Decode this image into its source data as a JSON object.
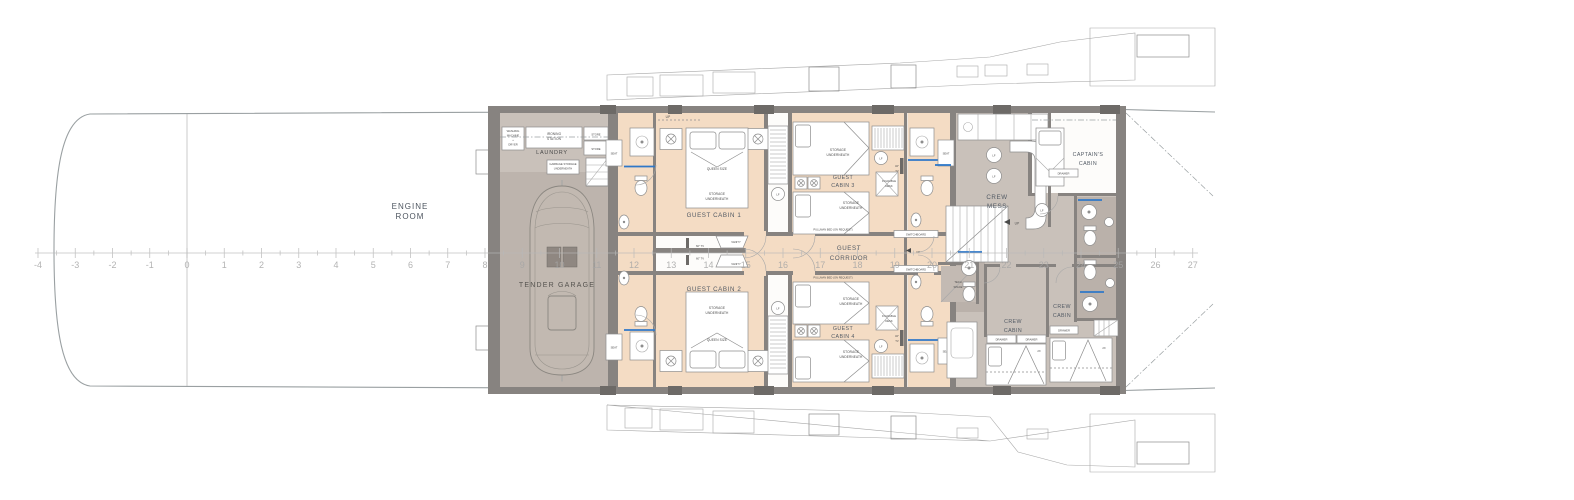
{
  "rooms": {
    "engine_room_l1": "ENGINE",
    "engine_room_l2": "ROOM",
    "laundry": "LAUNDRY",
    "tender_garage": "TENDER GARAGE",
    "guest_cabin_1": "GUEST CABIN 1",
    "guest_cabin_2": "GUEST CABIN 2",
    "guest_cabin_3_l1": "GUEST",
    "guest_cabin_3_l2": "CABIN 3",
    "guest_cabin_4_l1": "GUEST",
    "guest_cabin_4_l2": "CABIN 4",
    "guest_corridor_l1": "GUEST",
    "guest_corridor_l2": "CORRIDOR",
    "crew_mess_l1": "CREW",
    "crew_mess_l2": "MESS",
    "captains_cabin_l1": "CAPTAIN'S",
    "captains_cabin_l2": "CABIN",
    "crew_cabin_l1": "CREW",
    "crew_cabin_l2": "CABIN",
    "tech_space_l1": "TECH",
    "tech_space_l2": "SPACE"
  },
  "fixtures": {
    "washing_l1": "WASHING",
    "washing_l2": "MACHINE",
    "washing_l3": "+",
    "washing_l4": "DRYER",
    "ironing_l1": "IRONING",
    "ironing_l2": "STATION",
    "store": "STORE",
    "garbage_l1": "GARBAGE STORAGE",
    "garbage_l2": "UNDERNEATH",
    "queen_size": "QUEEN SIZE",
    "storage_l1": "STORAGE",
    "storage_l2": "UNDERNEATH",
    "pullman": "PULLMAN BED (ON REQUEST)",
    "foldable_l1": "FOLDABLE",
    "foldable_l2": "DESK",
    "tv32_l1": "32\"",
    "tv32_l2": "TV",
    "tv60": "60\" TV",
    "vanity": "VANITY",
    "seat": "SEAT",
    "lf": "LF",
    "up": "UP",
    "switchboard": "SWITCHBOARD",
    "drawer": "DRAWER",
    "bed2x": "2X"
  },
  "ruler": {
    "numbers": [
      "-4",
      "-3",
      "-2",
      "-1",
      "0",
      "1",
      "2",
      "3",
      "4",
      "5",
      "6",
      "7",
      "8",
      "9",
      "10",
      "11",
      "12",
      "13",
      "14",
      "15",
      "16",
      "17",
      "18",
      "19",
      "20",
      "21",
      "22",
      "23",
      "24",
      "25",
      "26",
      "27"
    ]
  },
  "colors": {
    "cabin_fill": "#f4dcc4",
    "crew_fill": "#c9c1ba",
    "garage_fill": "#bdb4ad",
    "wall": "#878380",
    "shower_accent": "#2f78c8",
    "ruler_text": "#a6a6a6"
  }
}
